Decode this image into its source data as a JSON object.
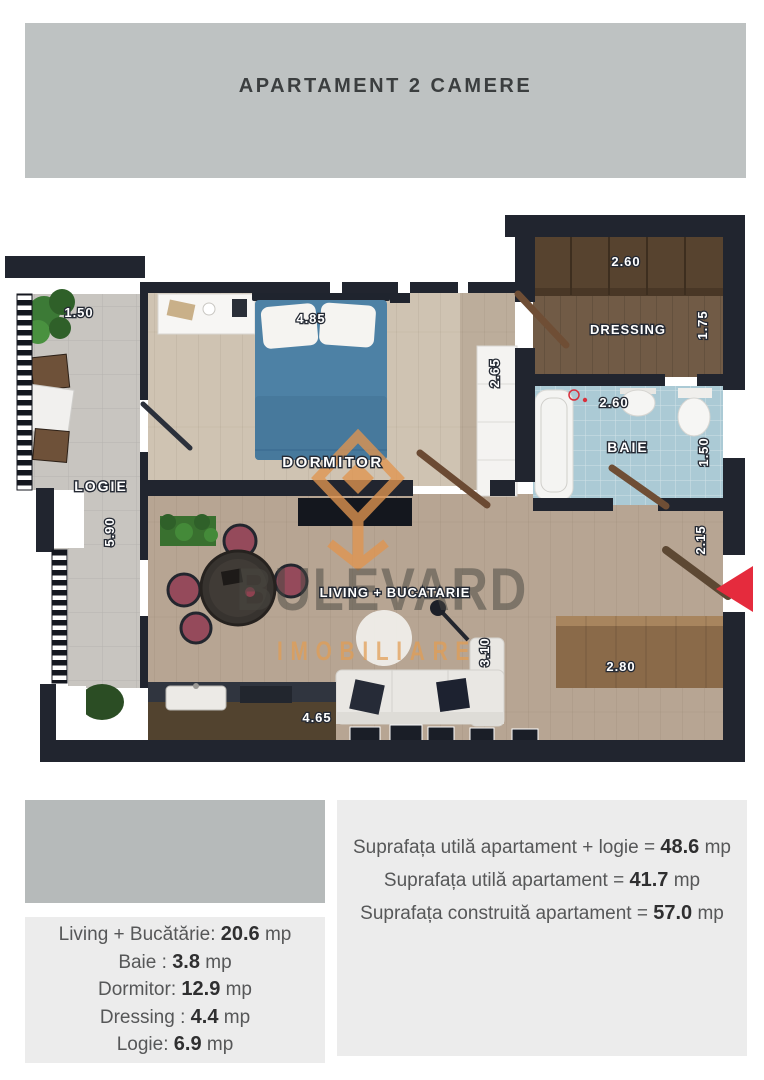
{
  "header": {
    "title": "APARTAMENT 2 CAMERE"
  },
  "watermark": {
    "name": "BULEVARD",
    "subtitle": "IMOBILIARE"
  },
  "plan": {
    "rooms": {
      "dormitor": "DORMITOR",
      "dressing": "DRESSING",
      "baie": "BAIE",
      "logie": "LOGIE",
      "living": "LIVING + BUCATARIE"
    },
    "dims": {
      "logie_width": "1.50",
      "dormitor_width": "4.85",
      "dressing_width": "2.60",
      "dressing_depth": "1.75",
      "hall_depth": "2.65",
      "baie_width": "2.60",
      "baie_depth": "1.50",
      "logie_length": "5.90",
      "entry_depth": "2.15",
      "living_depth": "3.10",
      "counter_width": "2.80",
      "living_width": "4.65"
    }
  },
  "areas": {
    "summary": [
      {
        "label": "Suprafața utilă apartament + logie =",
        "value": "48.6",
        "unit": "mp"
      },
      {
        "label": "Suprafața utilă apartament =",
        "value": "41.7",
        "unit": "mp"
      },
      {
        "label": "Suprafața construită apartament =",
        "value": "57.0",
        "unit": "mp"
      }
    ],
    "rooms": [
      {
        "label": "Living + Bucătărie:",
        "value": "20.6",
        "unit": "mp"
      },
      {
        "label": "Baie :",
        "value": "3.8",
        "unit": "mp"
      },
      {
        "label": "Dormitor:",
        "value": "12.9",
        "unit": "mp"
      },
      {
        "label": "Dressing :",
        "value": "4.4",
        "unit": "mp"
      },
      {
        "label": "Logie:",
        "value": "6.9",
        "unit": "mp"
      }
    ]
  }
}
